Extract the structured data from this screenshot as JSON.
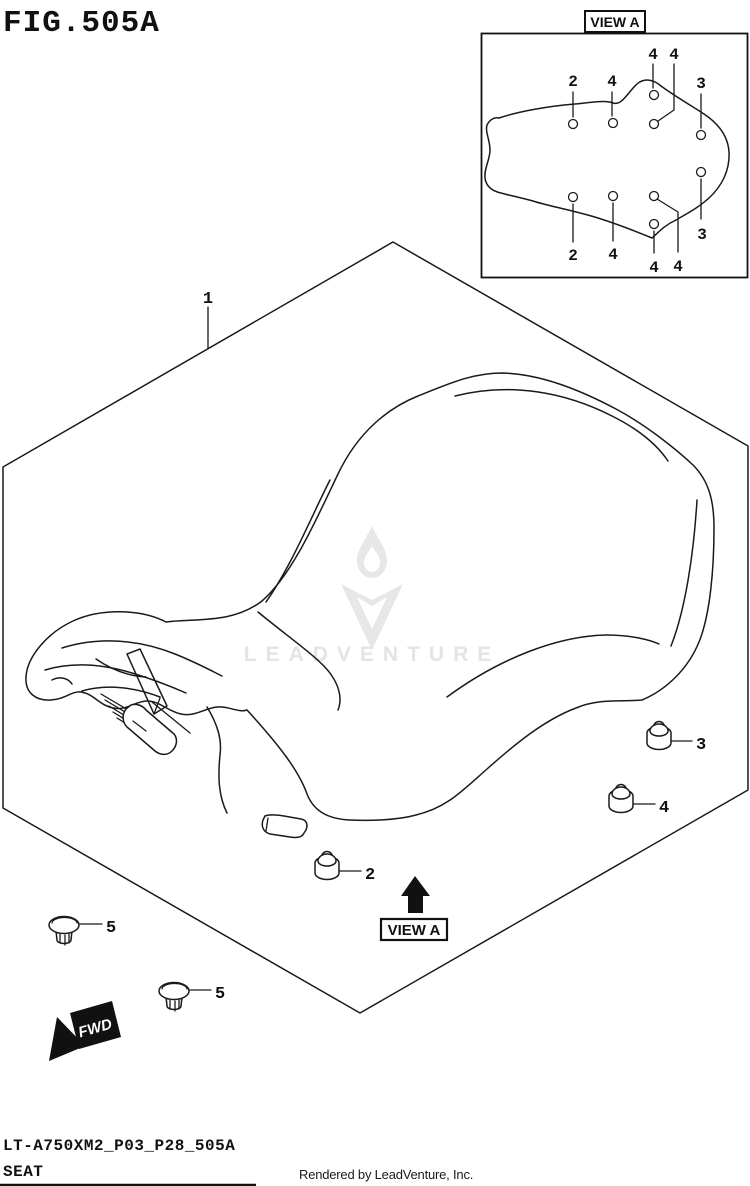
{
  "page": {
    "title": "FIG.505A",
    "footer": {
      "doc_code": "LT-A750XM2_P03_P28_505A",
      "part_title": "SEAT",
      "credit": "Rendered by LeadVenture, Inc."
    }
  },
  "drawing": {
    "view_label": "VIEW A",
    "fwd_label": "FWD",
    "watermark": "LEADVENTURE",
    "colors": {
      "line": "#1a1a1a",
      "text": "#111111",
      "watermark": "#e4e4e4",
      "background": "#ffffff"
    },
    "callouts": {
      "seat": "1",
      "nut_front": "2",
      "nut_rear": "3",
      "nut_mid": "4",
      "plug_upper": "5",
      "plug_lower": "5"
    },
    "inset": {
      "label": "VIEW A",
      "top_row": [
        "2",
        "4",
        "4",
        "4",
        "3"
      ],
      "bottom_row": [
        "2",
        "4",
        "4",
        "4",
        "3"
      ]
    }
  }
}
